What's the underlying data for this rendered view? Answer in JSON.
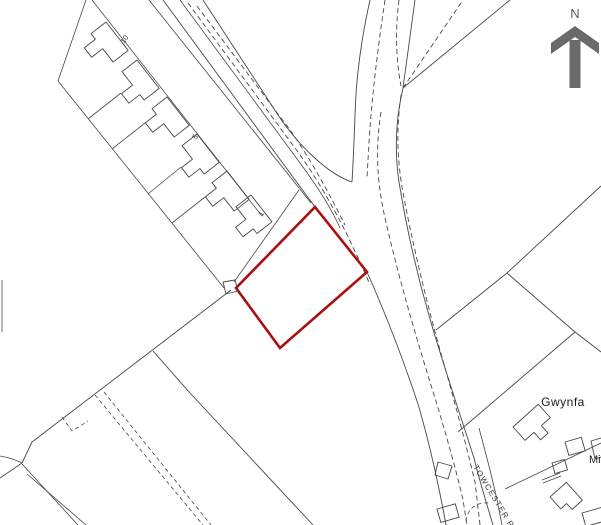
{
  "map": {
    "description": "site location plan with red line boundary",
    "background_color": "#ffffff",
    "line_color": "#474747",
    "north_arrow": {
      "label": "N",
      "color": "#6a6a6a"
    },
    "red_line_plot": {
      "color": "#aa0e0e",
      "points": "315,207 367,272 280,348 236,288"
    },
    "road": {
      "name_label": "TOWCESTER R"
    },
    "properties": {
      "name_label": "Gwynfa",
      "partial_label": "Mi"
    },
    "house_numbers": {
      "n10": "10",
      "n5": "5",
      "n1": "1"
    }
  }
}
